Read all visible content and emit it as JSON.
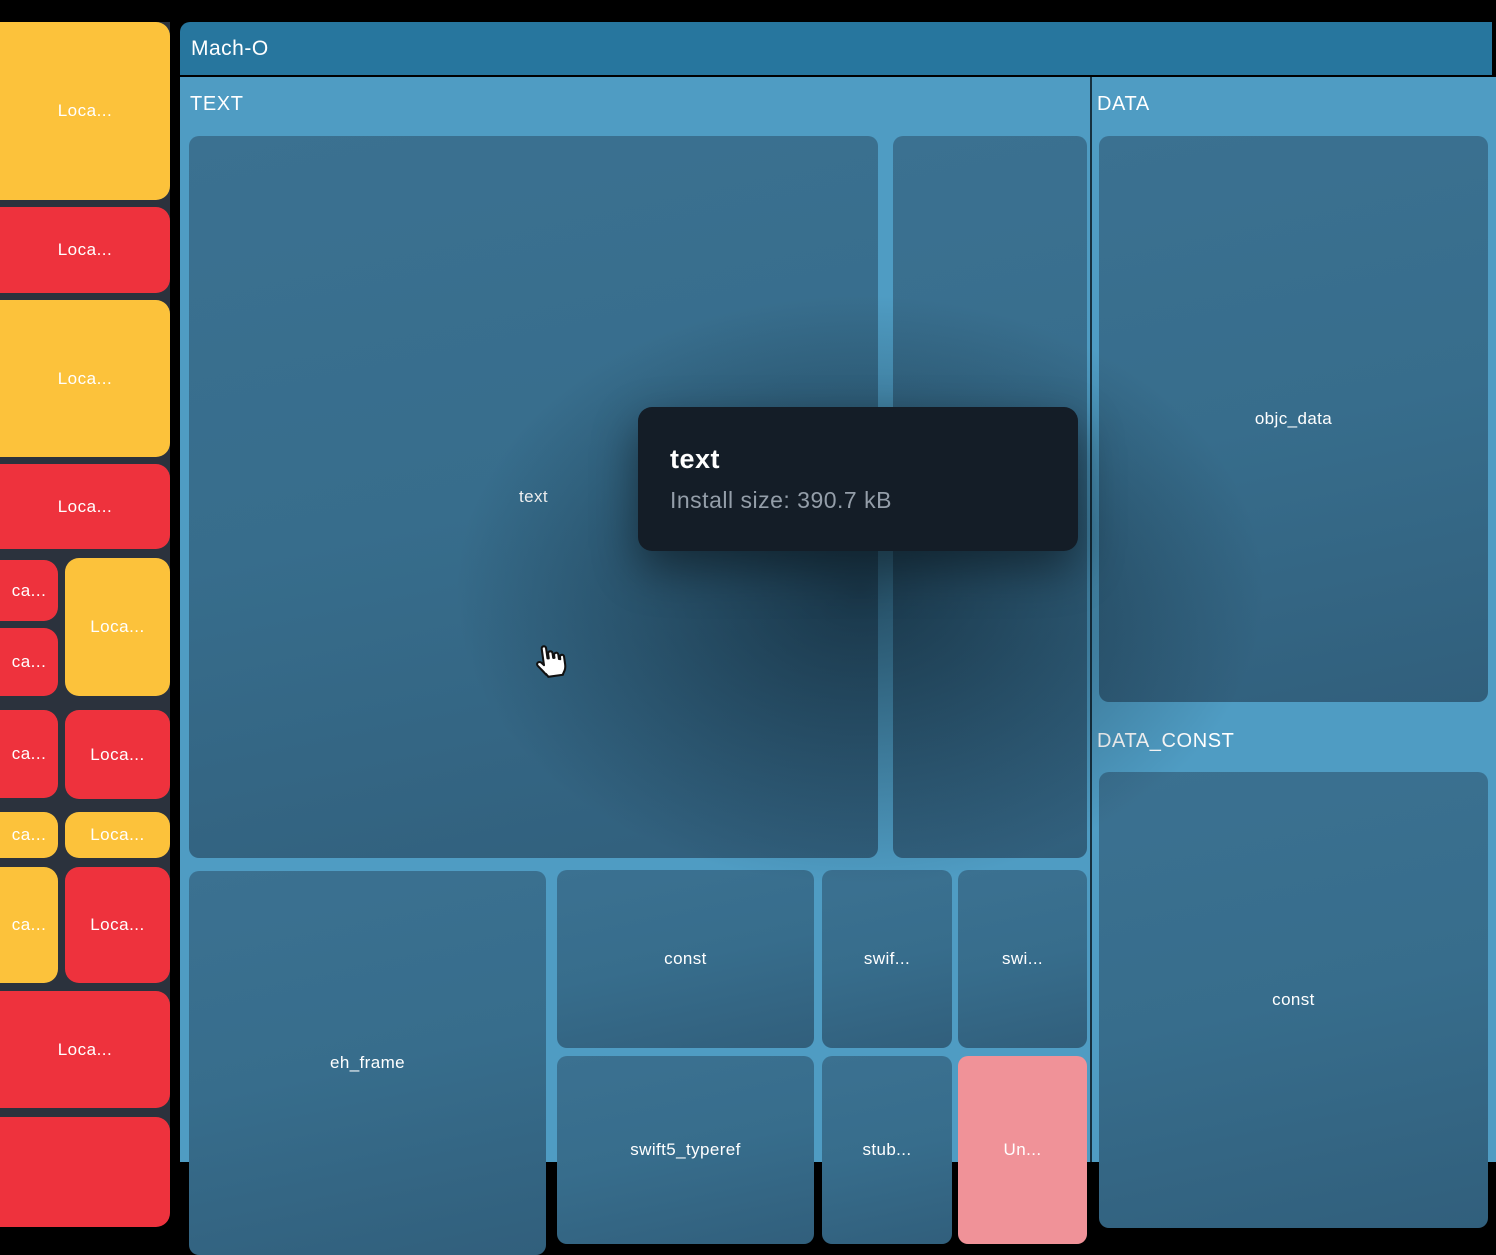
{
  "colors": {
    "page_bg": "#000000",
    "sidebar_bg": "#2b323d",
    "yellow": "#fcc23b",
    "red": "#ee323d",
    "salmon": "#f09298",
    "root_header_bg": "#27769e",
    "section_bg": "#4f9cc3",
    "block_teal": "#386e8c",
    "tooltip_bg": "#141d27",
    "tooltip_subtext": "#949ea9"
  },
  "treemap": {
    "root_label": "Mach-O",
    "panels": [
      {
        "name": "TEXT",
        "x": 180,
        "y": 77,
        "w": 910,
        "h": 1085
      },
      {
        "name": "DATA",
        "x": 1092,
        "y": 77,
        "w": 404,
        "h": 1085
      }
    ],
    "section_labels": [
      {
        "text": "TEXT",
        "x": 190,
        "y": 93
      },
      {
        "text": "DATA",
        "x": 1097,
        "y": 93
      },
      {
        "text": "DATA_CONST",
        "x": 1097,
        "y": 730
      }
    ],
    "blocks": [
      {
        "label": "text",
        "x": 189,
        "y": 136,
        "w": 689,
        "h": 722,
        "color": "teal"
      },
      {
        "label": "",
        "x": 893,
        "y": 136,
        "w": 194,
        "h": 722,
        "color": "teal"
      },
      {
        "label": "eh_frame",
        "x": 189,
        "y": 871,
        "w": 357,
        "h": 384,
        "color": "teal"
      },
      {
        "label": "const",
        "x": 557,
        "y": 870,
        "w": 257,
        "h": 178,
        "color": "teal"
      },
      {
        "label": "swif...",
        "x": 822,
        "y": 870,
        "w": 130,
        "h": 178,
        "color": "teal"
      },
      {
        "label": "swi...",
        "x": 958,
        "y": 870,
        "w": 129,
        "h": 178,
        "color": "teal"
      },
      {
        "label": "swift5_typeref",
        "x": 557,
        "y": 1056,
        "w": 257,
        "h": 188,
        "color": "teal"
      },
      {
        "label": "stub...",
        "x": 822,
        "y": 1056,
        "w": 130,
        "h": 188,
        "color": "teal"
      },
      {
        "label": "Un...",
        "x": 958,
        "y": 1056,
        "w": 129,
        "h": 188,
        "color": "salmon"
      },
      {
        "label": "objc_data",
        "x": 1099,
        "y": 136,
        "w": 389,
        "h": 566,
        "color": "teal"
      },
      {
        "label": "const",
        "x": 1099,
        "y": 772,
        "w": 389,
        "h": 456,
        "color": "teal"
      }
    ]
  },
  "sidebar": {
    "items": [
      {
        "label": "Loca...",
        "color": "yellow",
        "x": 0,
        "y": 22,
        "w": 170,
        "h": 178
      },
      {
        "label": "Loca...",
        "color": "red",
        "x": 0,
        "y": 207,
        "w": 170,
        "h": 86
      },
      {
        "label": "Loca...",
        "color": "yellow",
        "x": 0,
        "y": 300,
        "w": 170,
        "h": 157
      },
      {
        "label": "Loca...",
        "color": "red",
        "x": 0,
        "y": 464,
        "w": 170,
        "h": 85
      },
      {
        "label": "ca...",
        "color": "red",
        "x": 0,
        "y": 560,
        "w": 58,
        "h": 61
      },
      {
        "label": "Loca...",
        "color": "yellow",
        "x": 65,
        "y": 558,
        "w": 105,
        "h": 138
      },
      {
        "label": "ca...",
        "color": "red",
        "x": 0,
        "y": 628,
        "w": 58,
        "h": 68
      },
      {
        "label": "ca...",
        "color": "red",
        "x": 0,
        "y": 710,
        "w": 58,
        "h": 88
      },
      {
        "label": "Loca...",
        "color": "red",
        "x": 65,
        "y": 710,
        "w": 105,
        "h": 89
      },
      {
        "label": "ca...",
        "color": "yellow",
        "x": 0,
        "y": 812,
        "w": 58,
        "h": 46
      },
      {
        "label": "Loca...",
        "color": "yellow",
        "x": 65,
        "y": 812,
        "w": 105,
        "h": 46
      },
      {
        "label": "ca...",
        "color": "yellow",
        "x": 0,
        "y": 867,
        "w": 58,
        "h": 116
      },
      {
        "label": "Loca...",
        "color": "red",
        "x": 65,
        "y": 867,
        "w": 105,
        "h": 116
      },
      {
        "label": "Loca...",
        "color": "red",
        "x": 0,
        "y": 991,
        "w": 170,
        "h": 117
      },
      {
        "label": "",
        "color": "red",
        "x": 0,
        "y": 1117,
        "w": 170,
        "h": 110
      }
    ]
  },
  "tooltip": {
    "title": "text",
    "detail": "Install size: 390.7 kB"
  },
  "cursor": {
    "type": "pointer-hand"
  }
}
